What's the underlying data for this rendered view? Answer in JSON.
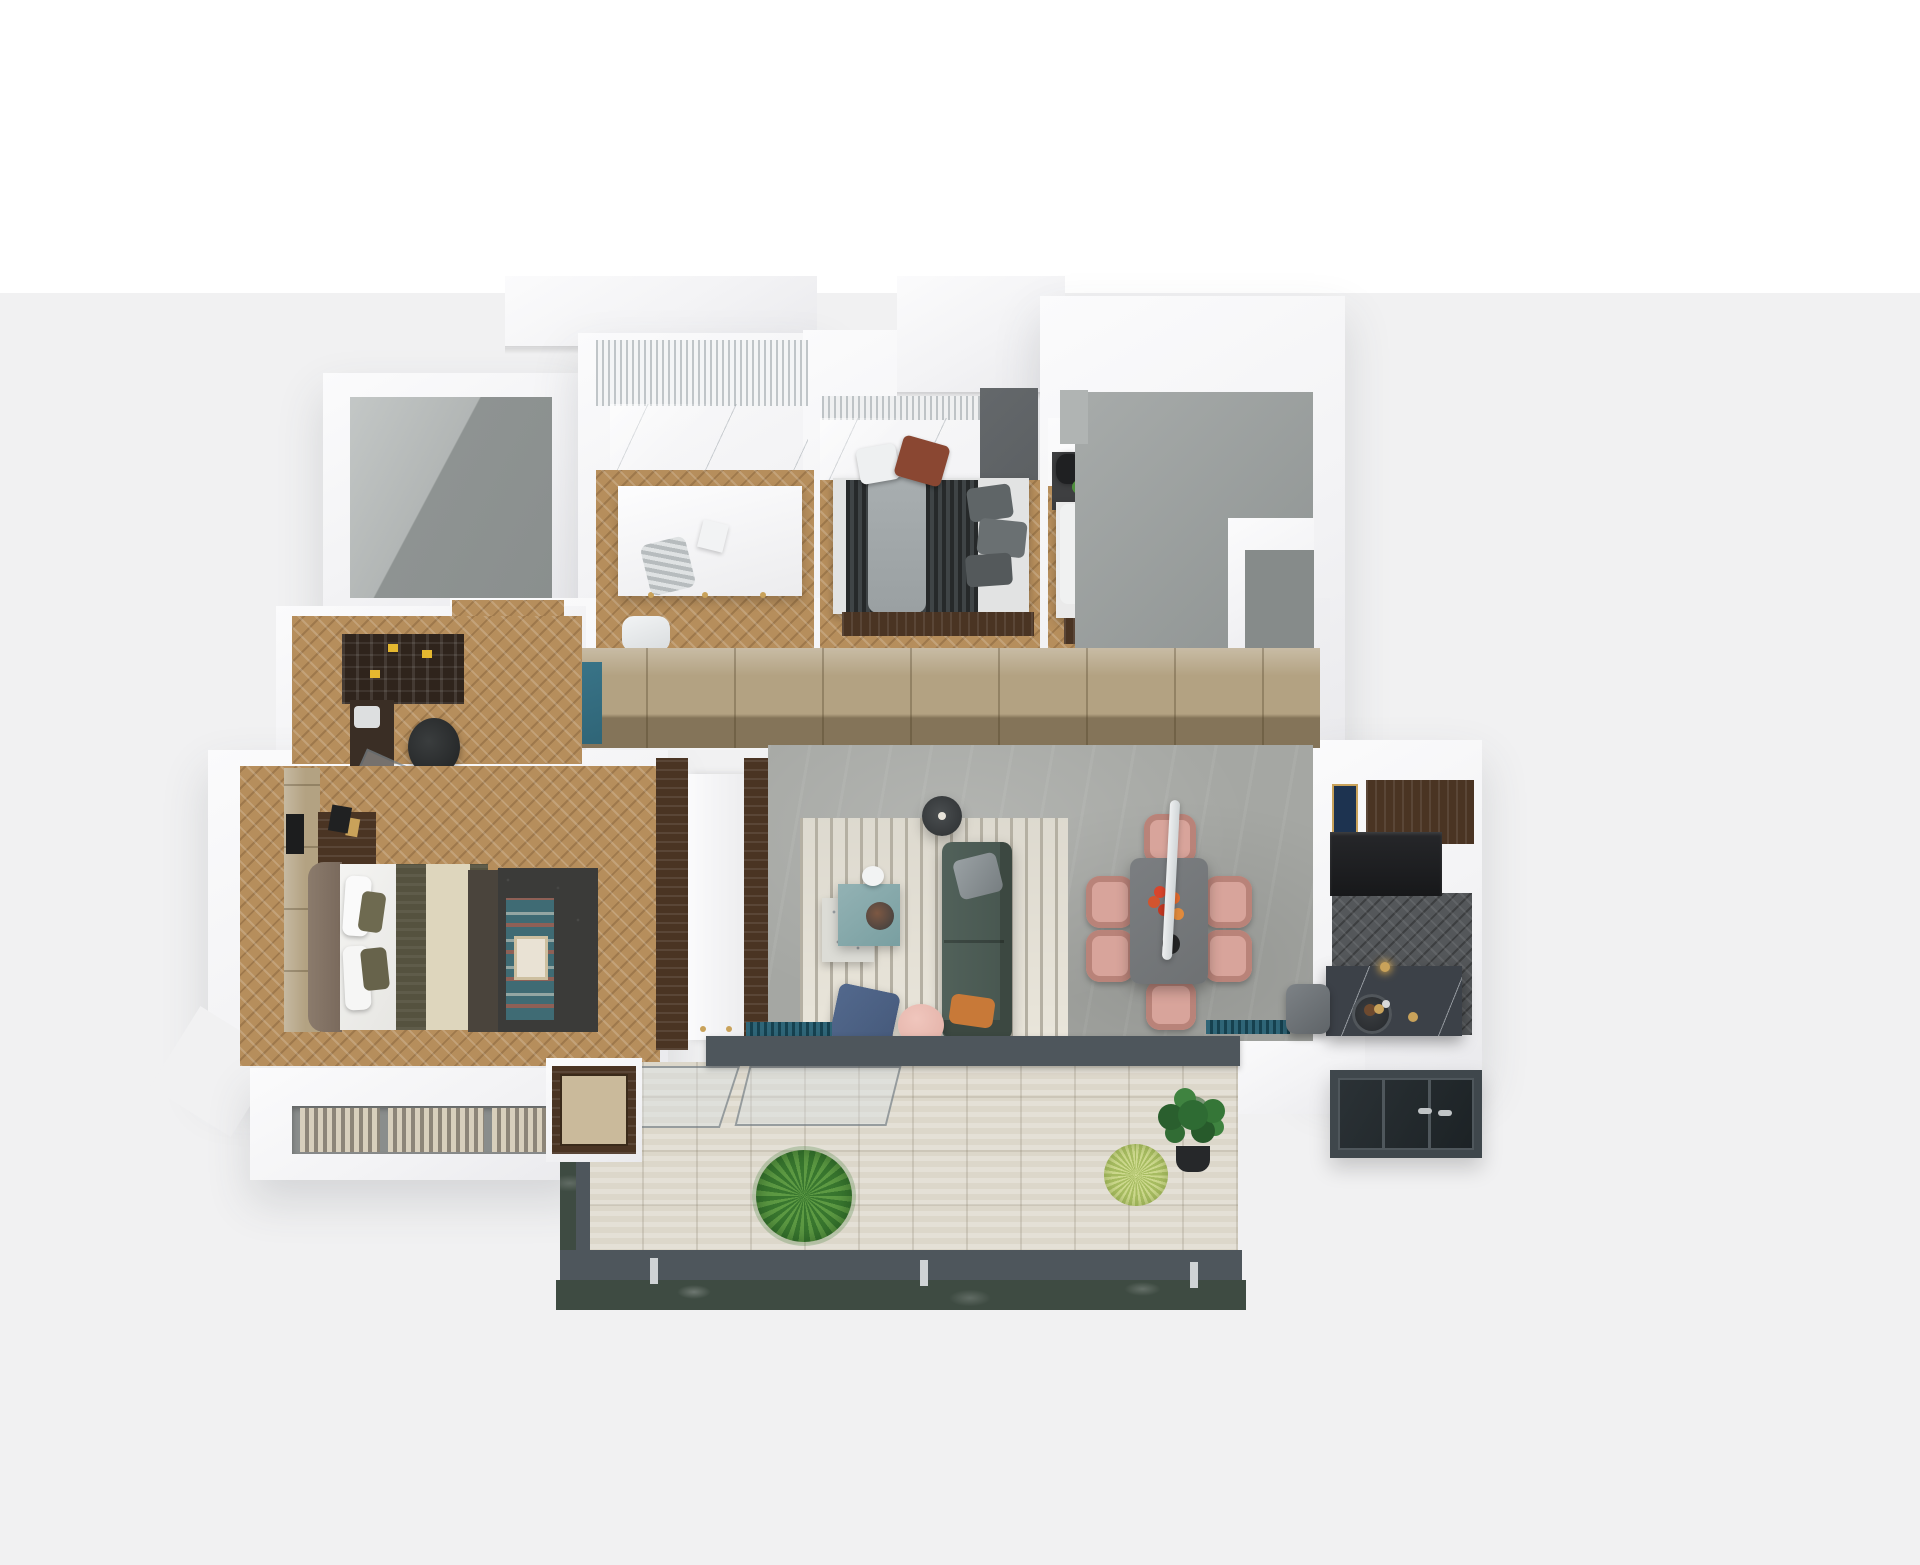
{
  "scene": {
    "type": "3d-floorplan-axonometric-render",
    "rooms": [
      "duct-shaft",
      "dressing-room",
      "bedroom-middle",
      "bedroom-right",
      "entry-stair-zone",
      "wardrobe-corridor",
      "study-nook",
      "master-bedroom",
      "living-room",
      "dining-area",
      "kitchen",
      "main-balcony",
      "utility-glazed-balcony",
      "ac-ledge"
    ],
    "furniture": [
      "vanity-island",
      "double-bed-dark",
      "double-bed-beige",
      "master-bed",
      "bookshelf",
      "desk",
      "office-chair",
      "tv-panel",
      "striped-rug",
      "coffee-table",
      "floor-lamp",
      "sofa",
      "armchair",
      "pouf",
      "dining-table",
      "dining-chairs-x6",
      "pendant-bar-lamp",
      "kitchen-island",
      "bar-stool",
      "balcony-plants-x3",
      "ac-units"
    ]
  },
  "palette": {
    "bg_band": "#f1f1f2",
    "wall_edge": "#d9d9db",
    "slab_shadow": "#d2d2d5",
    "gray_wall": "#bfc3c2",
    "gray_floor": "#8e9392",
    "gray_mid": "#a7abaa",
    "gray_step": "#868b8a",
    "wood": "#b68e5c",
    "walnut": "#4a3423",
    "kitchen_floor": "#54575a",
    "living_floor": "#a5a7a3",
    "tan": "#b3a282",
    "tan_dark": "#8f8164",
    "teal_cabinet": "#2f6577",
    "duvet_a": "#26292a",
    "duvet_b": "#3f4446",
    "throw_gray": "#9aa0a2",
    "pillow_rust": "#8a4732",
    "wardrobe_gray": "#5c6063",
    "bed_beige": "#cbb9a2",
    "throw_brown": "#7a4a28",
    "curtain_gray": "#a8adad",
    "gold": "#c9a25a",
    "headboard_taupe": "#8b7b6c",
    "olive": "#55523f",
    "cream_band": "#ded6bd",
    "bench_dark": "#4a443c",
    "rug_dark": "#3b3b39",
    "teal_runner": "#3f6b74",
    "sofa": "#47564f",
    "sofa_dark": "#3c4841",
    "pillow_orange": "#c87938",
    "armchair_navy": "#45597a",
    "pouf": "#e2b0a6",
    "chair_blush": "#d8a49b",
    "chair_blush_dark": "#b98379",
    "table_gray": "#6e7173",
    "rug_cream": "#e9e5da",
    "rug_stripe": "#b5b0a3",
    "lamp_dark": "#3a3d3f",
    "island": "#3c4148",
    "counter_black": "#17181a",
    "navy_art": "#1d3350",
    "deck": "#dcd7ca",
    "slate": "#4e565c",
    "green_marble": "#3e4b42",
    "plant_a": "#5d9a43",
    "plant_b": "#39772f",
    "plant_spiky_a": "#cdd98e",
    "plant_spiky_b": "#a8bd62",
    "fiddle": "#2e6b33",
    "pot": "#26282a",
    "ac_a": "#d8cfbc",
    "ac_b": "#8d8578",
    "white_soft": "#f7f8f8"
  }
}
